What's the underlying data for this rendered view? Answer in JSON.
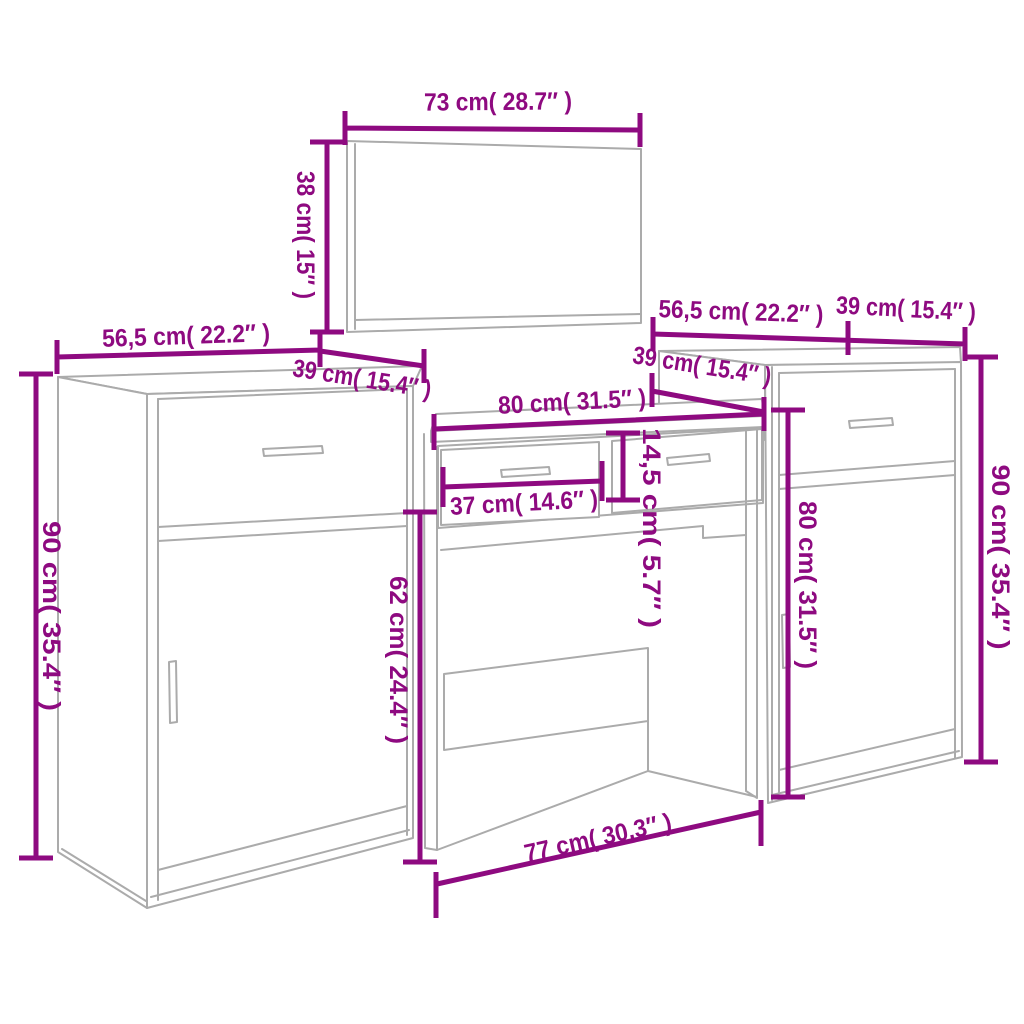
{
  "diagram": {
    "type": "furniture-dimension-diagram",
    "subject": "dressing table set with mirror and two cabinets",
    "colors": {
      "dimension_text": "#8E0A80",
      "furniture_lines": "#ABABAB",
      "background": "#FFFFFF"
    },
    "dimensions": {
      "mirror_width": "73 cm( 28.7″ )",
      "mirror_height": "38 cm( 15″ )",
      "left_cabinet_width": "56,5 cm( 22.2″ )",
      "left_cabinet_depth": "39 cm( 15.4″ )",
      "left_cabinet_height": "90 cm( 35.4″ )",
      "table_width": "80 cm( 31.5″ )",
      "table_depth": "39 cm( 15.4″ )",
      "table_drawer_width": "37 cm( 14.6″ )",
      "table_drawer_height": "14,5 cm( 5.7″ )",
      "table_leg_clearance": "62 cm( 24.4″ )",
      "table_base_width": "77 cm( 30.3″ )",
      "right_cabinet_width": "56,5 cm( 22.2″ )",
      "right_cabinet_depth": "39 cm( 15.4″ )",
      "right_cabinet_front_height": "80 cm( 31.5″ )",
      "right_cabinet_height": "90 cm( 35.4″ )"
    }
  }
}
